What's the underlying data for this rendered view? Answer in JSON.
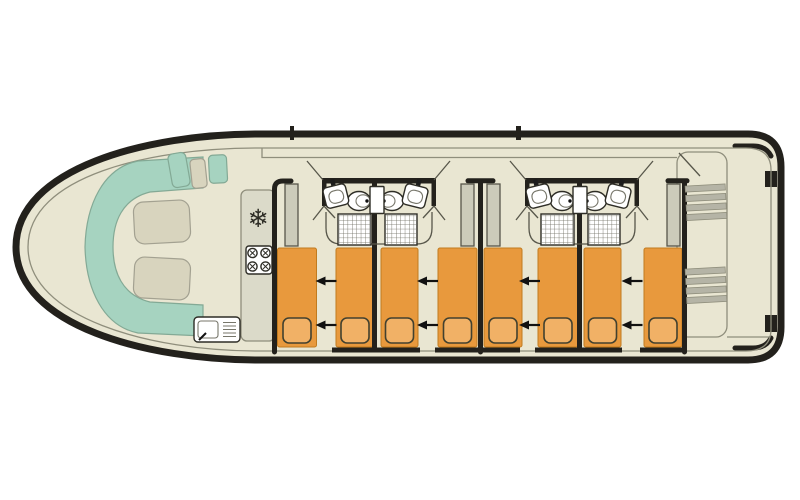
{
  "app": {
    "name": "boat-deck-floor-plan",
    "visible_text": ""
  },
  "colors": {
    "hull": "#23211c",
    "deck": "#e9e6d2",
    "line": "#8f8e7c",
    "teal": "#a6d3c0",
    "tealStroke": "#83a995",
    "cushion": "#d8d4be",
    "cushionStroke": "#a3a191",
    "counter": "#dbdac9",
    "counterStroke": "#8f8e7c",
    "wardrobe": "#cccbba",
    "wardrobeStroke": "#57564a",
    "bed": "#e8993d",
    "bedStroke": "#c17b1e",
    "pillow": "#f1b166",
    "pillowStroke": "#42412f",
    "wall": "#23211c",
    "fixtureStroke": "#2e2d26",
    "grid": "#6b6a5e",
    "stair": "#b5b4a6",
    "stairStroke": "#8f8e7c",
    "arrow": "#111111",
    "door": "#57564a"
  },
  "icons": {
    "fridge": "❄",
    "fridge_name": "snowflake-icon",
    "arrow_name": "slide-arrow-icon"
  },
  "berths": {
    "y": 248,
    "h": 99,
    "pillow_y": 318,
    "pillow_h": 25,
    "pillow_w": 28,
    "items": [
      {
        "x": 277.5,
        "w": 39
      },
      {
        "x": 336,
        "w": 38
      },
      {
        "x": 381,
        "w": 37
      },
      {
        "x": 438,
        "w": 39
      },
      {
        "x": 484,
        "w": 38
      },
      {
        "x": 538,
        "w": 40
      },
      {
        "x": 584,
        "w": 37
      },
      {
        "x": 644,
        "w": 38
      }
    ]
  },
  "arrows": {
    "rows": [
      281,
      325
    ],
    "cx": [
      326.5,
      428,
      530,
      632.5
    ]
  },
  "bathrooms": {
    "blocks_x": [
      322,
      525
    ],
    "top_y": 178,
    "width": 114,
    "fixtures": [
      "washbasin",
      "washbasin",
      "toilet",
      "toilet",
      "cistern",
      "shower",
      "shower"
    ]
  },
  "wardrobes": {
    "y": 184,
    "w": 13,
    "h": 62,
    "x": [
      285,
      461,
      487,
      667
    ]
  },
  "stairs": {
    "x": 686,
    "w": 40,
    "bar_h": 6,
    "bars": 4,
    "ys": [
      185,
      268
    ]
  }
}
